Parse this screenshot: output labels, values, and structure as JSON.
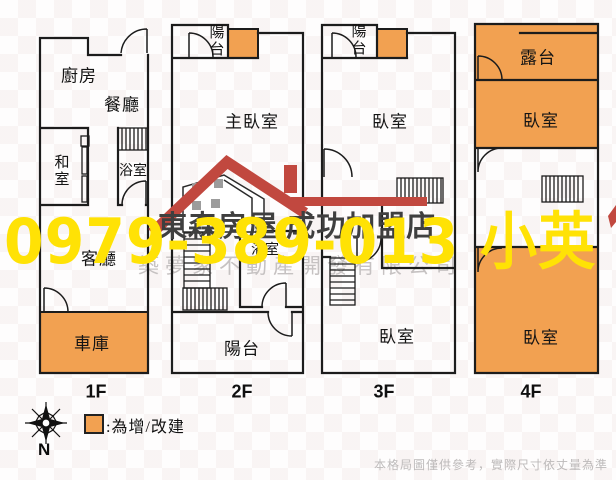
{
  "watermarks": {
    "phone": "0979-389-013 小英",
    "agency": "東森房屋 成功加盟店",
    "company": "築夢家不動產開發有限公司"
  },
  "legend": {
    "compass": "N",
    "addition_note": ":為增/改建"
  },
  "footer": {
    "disclaimer": "本格局圖僅供參考，實際尺寸依丈量為準"
  },
  "colors": {
    "addition_fill": "#F2A151",
    "logo_red": "#C1483F",
    "watermark_yellow": "#FFE205",
    "company_gray": "#C6C2C2",
    "wall": "#1C1C1C"
  },
  "floors": [
    {
      "label": "1F",
      "rooms": [
        {
          "name": "廚房"
        },
        {
          "name": "餐廳"
        },
        {
          "name": "和室"
        },
        {
          "name": "浴室"
        },
        {
          "name": "客廳"
        },
        {
          "name": "車庫"
        }
      ]
    },
    {
      "label": "2F",
      "rooms": [
        {
          "name": "陽台"
        },
        {
          "name": "主臥室"
        },
        {
          "name": "浴室"
        },
        {
          "name": "陽台"
        }
      ]
    },
    {
      "label": "3F",
      "rooms": [
        {
          "name": "陽台"
        },
        {
          "name": "臥室"
        },
        {
          "name": "臥室"
        }
      ]
    },
    {
      "label": "4F",
      "rooms": [
        {
          "name": "露台"
        },
        {
          "name": "臥室"
        },
        {
          "name": "臥室"
        }
      ]
    }
  ]
}
